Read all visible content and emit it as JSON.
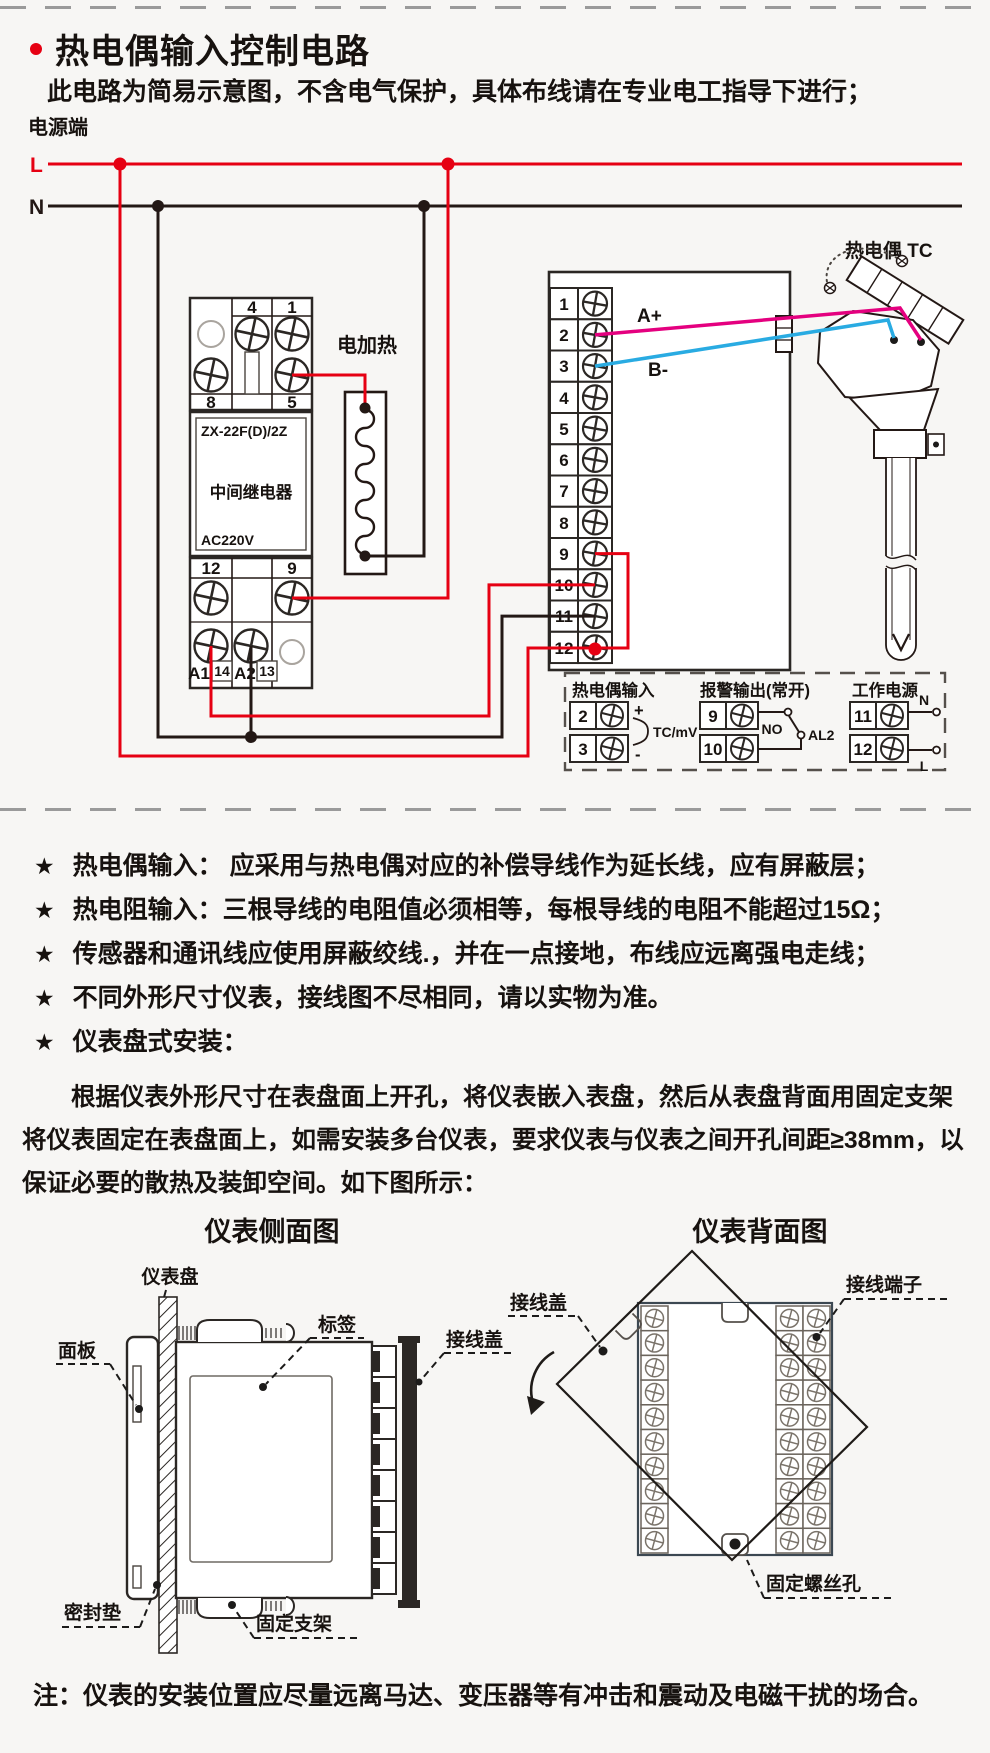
{
  "header": {
    "title": "热电偶输入控制电路",
    "subtitle": "此电路为简易示意图，不含电气保护，具体布线请在专业电工指导下进行；"
  },
  "circuit": {
    "power_label": "电源端",
    "line_l": "L",
    "line_n": "N",
    "heater_label": "电加热",
    "tc_label": "热电偶 TC",
    "wire_a": "A+",
    "wire_b": "B-",
    "relay": {
      "model": "ZX-22F(D)/2Z",
      "name": "中间继电器",
      "voltage": "AC220V",
      "pin4": "4",
      "pin1": "1",
      "pin8": "8",
      "pin5": "5",
      "pin12": "12",
      "pin9": "9",
      "pinA1": "A1",
      "pin14": "14",
      "pinA2": "A2",
      "pin13": "13"
    },
    "instrument": {
      "terminals": [
        "1",
        "2",
        "3",
        "4",
        "5",
        "6",
        "7",
        "8",
        "9",
        "10",
        "11",
        "12"
      ]
    },
    "legend": {
      "tc_input": {
        "title": "热电偶输入",
        "t2": "2",
        "t3": "3",
        "plus": "+",
        "minus": "-",
        "signal": "TC/mV"
      },
      "alarm": {
        "title": "报警输出(常开)",
        "t9": "9",
        "t10": "10",
        "no": "NO",
        "al": "AL2"
      },
      "power": {
        "title": "工作电源",
        "t11": "11",
        "t12": "12",
        "n": "N",
        "l": "L"
      }
    }
  },
  "notes": {
    "star": "★",
    "items": [
      {
        "text": "热电偶输入： 应采用与热电偶对应的补偿导线作为延长线，应有屏蔽层；"
      },
      {
        "text": "热电阻输入：三根导线的电阻值必须相等，每根导线的电阻不能超过15Ω；"
      },
      {
        "text": "传感器和通讯线应使用屏蔽绞线.，并在一点接地，布线应远离强电走线；"
      },
      {
        "text": "不同外形尺寸仪表，接线图不尽相同，请以实物为准。"
      },
      {
        "text": "仪表盘式安装："
      }
    ]
  },
  "install": {
    "paragraph": "根据仪表外形尺寸在表盘面上开孔，将仪表嵌入表盘，然后从表盘背面用固定支架将仪表固定在表盘面上，如需安装多台仪表，要求仪表与仪表之间开孔间距≥38mm，以保证必要的散热及装卸空间。如下图所示：",
    "side_view": {
      "title": "仪表侧面图",
      "labels": {
        "panel": "仪表盘",
        "front": "面板",
        "tag": "标签",
        "cover": "接线盖",
        "gasket": "密封垫",
        "bracket": "固定支架"
      }
    },
    "back_view": {
      "title": "仪表背面图",
      "labels": {
        "cover": "接线盖",
        "terminal": "接线端子",
        "screw_hole": "固定螺丝孔"
      }
    }
  },
  "footer": {
    "note": "注：仪表的安装位置应尽量远离马达、变压器等有冲击和震动及电磁干扰的场合。"
  },
  "colors": {
    "red": "#e60012",
    "pink": "#e4007f",
    "blue": "#29abe2",
    "ink": "#231815"
  }
}
